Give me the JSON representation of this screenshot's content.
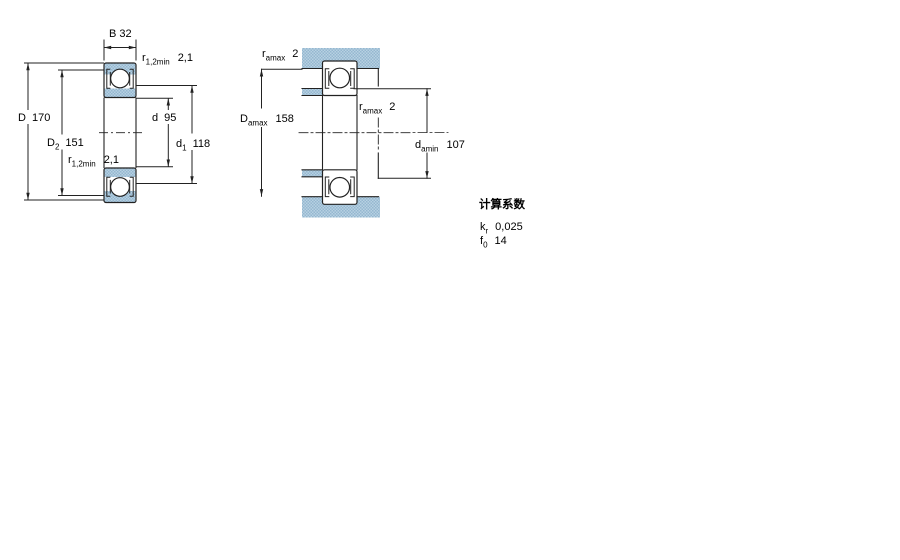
{
  "title": "bearing-dimension-drawing",
  "colors": {
    "hatch_light": "#b7d1e2",
    "hatch_dark": "#95b7d0",
    "line": "#222222",
    "background": "#ffffff"
  },
  "left_view": {
    "b_label": "B 32",
    "D": {
      "sym": "D",
      "val": "170"
    },
    "D2": {
      "sym": "D",
      "sub": "2",
      "val": "151"
    },
    "d": {
      "sym": "d",
      "val": "95"
    },
    "d1": {
      "sym": "d",
      "sub": "1",
      "val": "118"
    },
    "r_top": {
      "sym": "r",
      "sub": "1,2min",
      "val": "2,1"
    },
    "r_mid": {
      "sym": "r",
      "sub": "1,2min",
      "val": "2,1"
    }
  },
  "right_view": {
    "ra_top": {
      "sym": "r",
      "sub": "amax",
      "val": "2"
    },
    "ra_mid": {
      "sym": "r",
      "sub": "amax",
      "val": "2"
    },
    "Da": {
      "sym": "D",
      "sub": "amax",
      "val": "158"
    },
    "da": {
      "sym": "d",
      "sub": "amin",
      "val": "107"
    }
  },
  "calculation_factors": {
    "heading": "计算系数",
    "kr": {
      "sym": "k",
      "sub": "r",
      "val": "0,025"
    },
    "f0": {
      "sym": "f",
      "sub": "0",
      "val": "14"
    }
  }
}
